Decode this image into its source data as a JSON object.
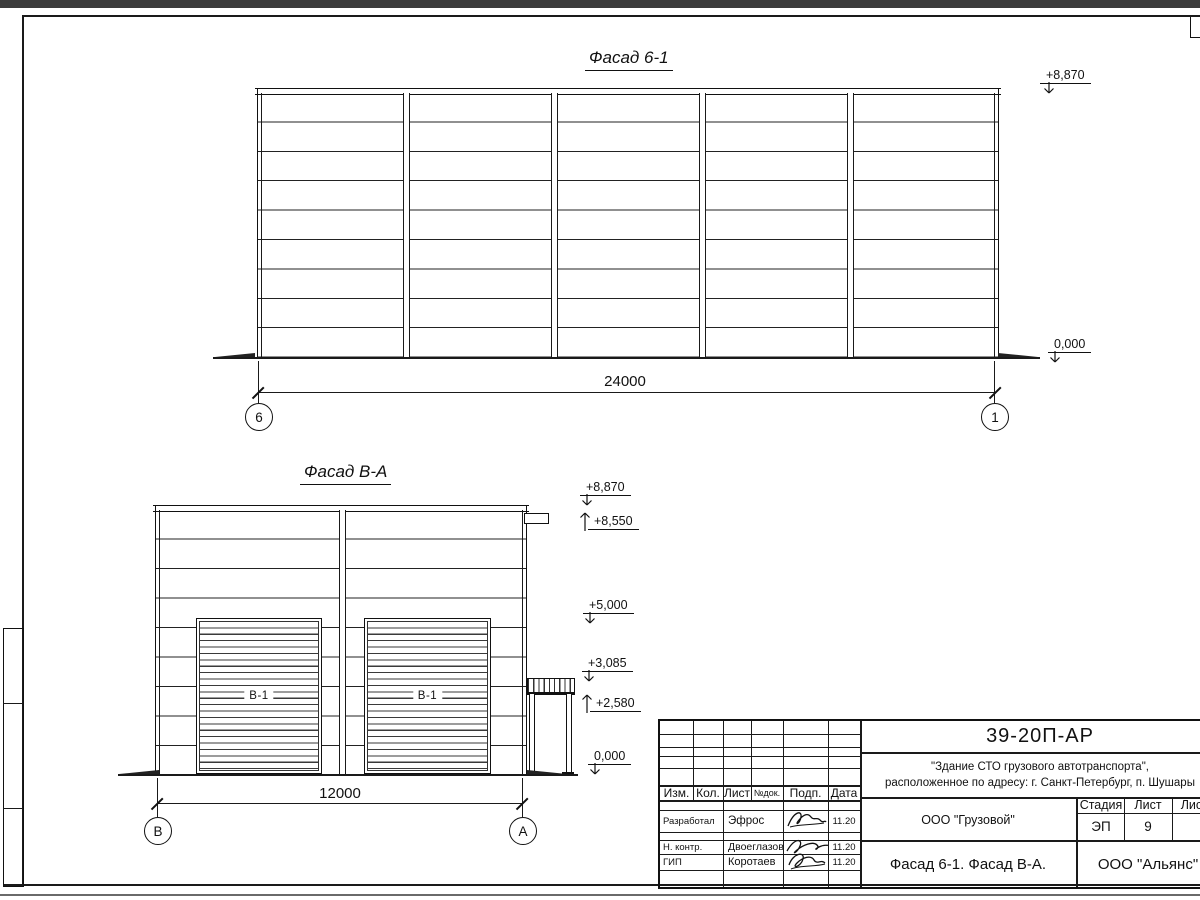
{
  "facade1": {
    "title": "Фасад 6-1",
    "dim": "24000",
    "axes": [
      "6",
      "1"
    ],
    "elevations": [
      "+8,870",
      "0,000"
    ]
  },
  "facade2": {
    "title": "Фасад В-А",
    "dim": "12000",
    "axes": [
      "В",
      "А"
    ],
    "door_label": "В-1",
    "elevations": [
      "+8,870",
      "+8,550",
      "+5,000",
      "+3,085",
      "+2,580",
      "0,000"
    ]
  },
  "titleblock": {
    "code": "39-20П-АР",
    "project_line1": "\"Здание СТО грузового автотранспорта\",",
    "project_line2": "расположенное по адресу: г. Санкт-Петербург, п. Шушары",
    "client": "ООО \"Грузовой\"",
    "doc_title": "Фасад 6-1. Фасад В-А.",
    "organization": "ООО \"Альянс\"",
    "stage_label": "Стадия",
    "stage_value": "ЭП",
    "sheet_label": "Лист",
    "sheet_value": "9",
    "sheets_label": "Листов",
    "header_cols": [
      "Изм.",
      "Кол.",
      "Лист",
      "№док.",
      "Подп.",
      "Дата"
    ],
    "staff": [
      {
        "role": "Разработал",
        "name": "Эфрос",
        "date": "11.20"
      },
      {
        "role": "Н. контр.",
        "name": "Двоеглазов",
        "date": "11.20"
      },
      {
        "role": "ГИП",
        "name": "Коротаев",
        "date": "11.20"
      }
    ]
  }
}
